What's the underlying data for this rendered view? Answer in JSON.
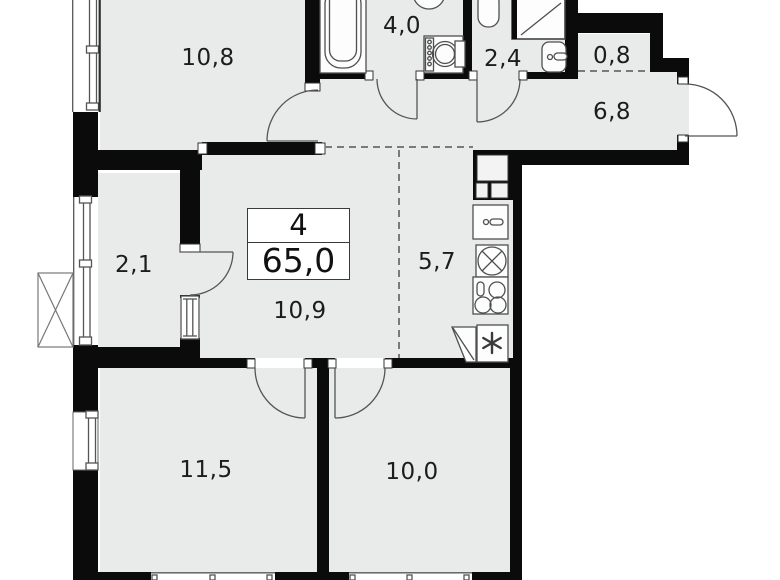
{
  "plan": {
    "info_box": {
      "rooms_count": "4",
      "total_area": "65,0"
    },
    "room_areas": {
      "bedroom_top": "10,8",
      "bathroom": "4,0",
      "wc": "2,4",
      "storage": "0,8",
      "hallway": "6,8",
      "wardrobe": "2,1",
      "kitchen": "5,7",
      "hall": "10,9",
      "bedroom_left": "11,5",
      "bedroom_right": "10,0"
    },
    "icons": [
      "bathtub-icon",
      "basin-icon",
      "washing-machine-icon",
      "shower-icon",
      "toilet-icon",
      "kitchen-sink-icon",
      "hob-icon",
      "stove-icon",
      "fridge-snowflake-icon",
      "ac-unit-icon",
      "vent-shaft-icon",
      "door-arc",
      "window-glazing"
    ],
    "colors": {
      "floor": "#e9ebea",
      "wall": "#0b0b0b",
      "line": "#4f4f4f",
      "dashed": "#7a7a7a",
      "text": "#1c1c1c",
      "background": "#ffffff"
    }
  }
}
